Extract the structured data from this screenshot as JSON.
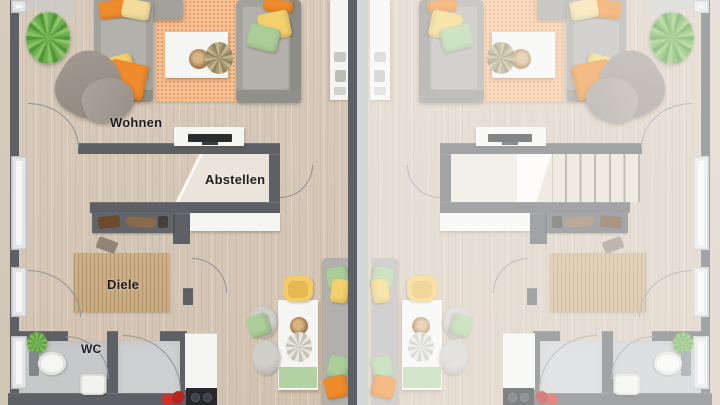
{
  "rooms": {
    "living": "Wohnen",
    "storage": "Abstellen",
    "hallway": "Diele",
    "wc": "WC"
  },
  "colors": {
    "wall": "#5d6165",
    "party_wall_light": "#b6b8ba",
    "floor_wood": "#d8cabb",
    "rug_living": "#f4bf92",
    "rug_hall": "#c9ab80",
    "wc_floor": "#c6c8ca",
    "accent_orange": "#ee8b2b",
    "accent_yellow": "#f2d06b",
    "accent_pale": "#f3dc9a",
    "accent_green": "#abce99",
    "tv_black": "#2a2c2e",
    "red_item": "#d03028"
  }
}
